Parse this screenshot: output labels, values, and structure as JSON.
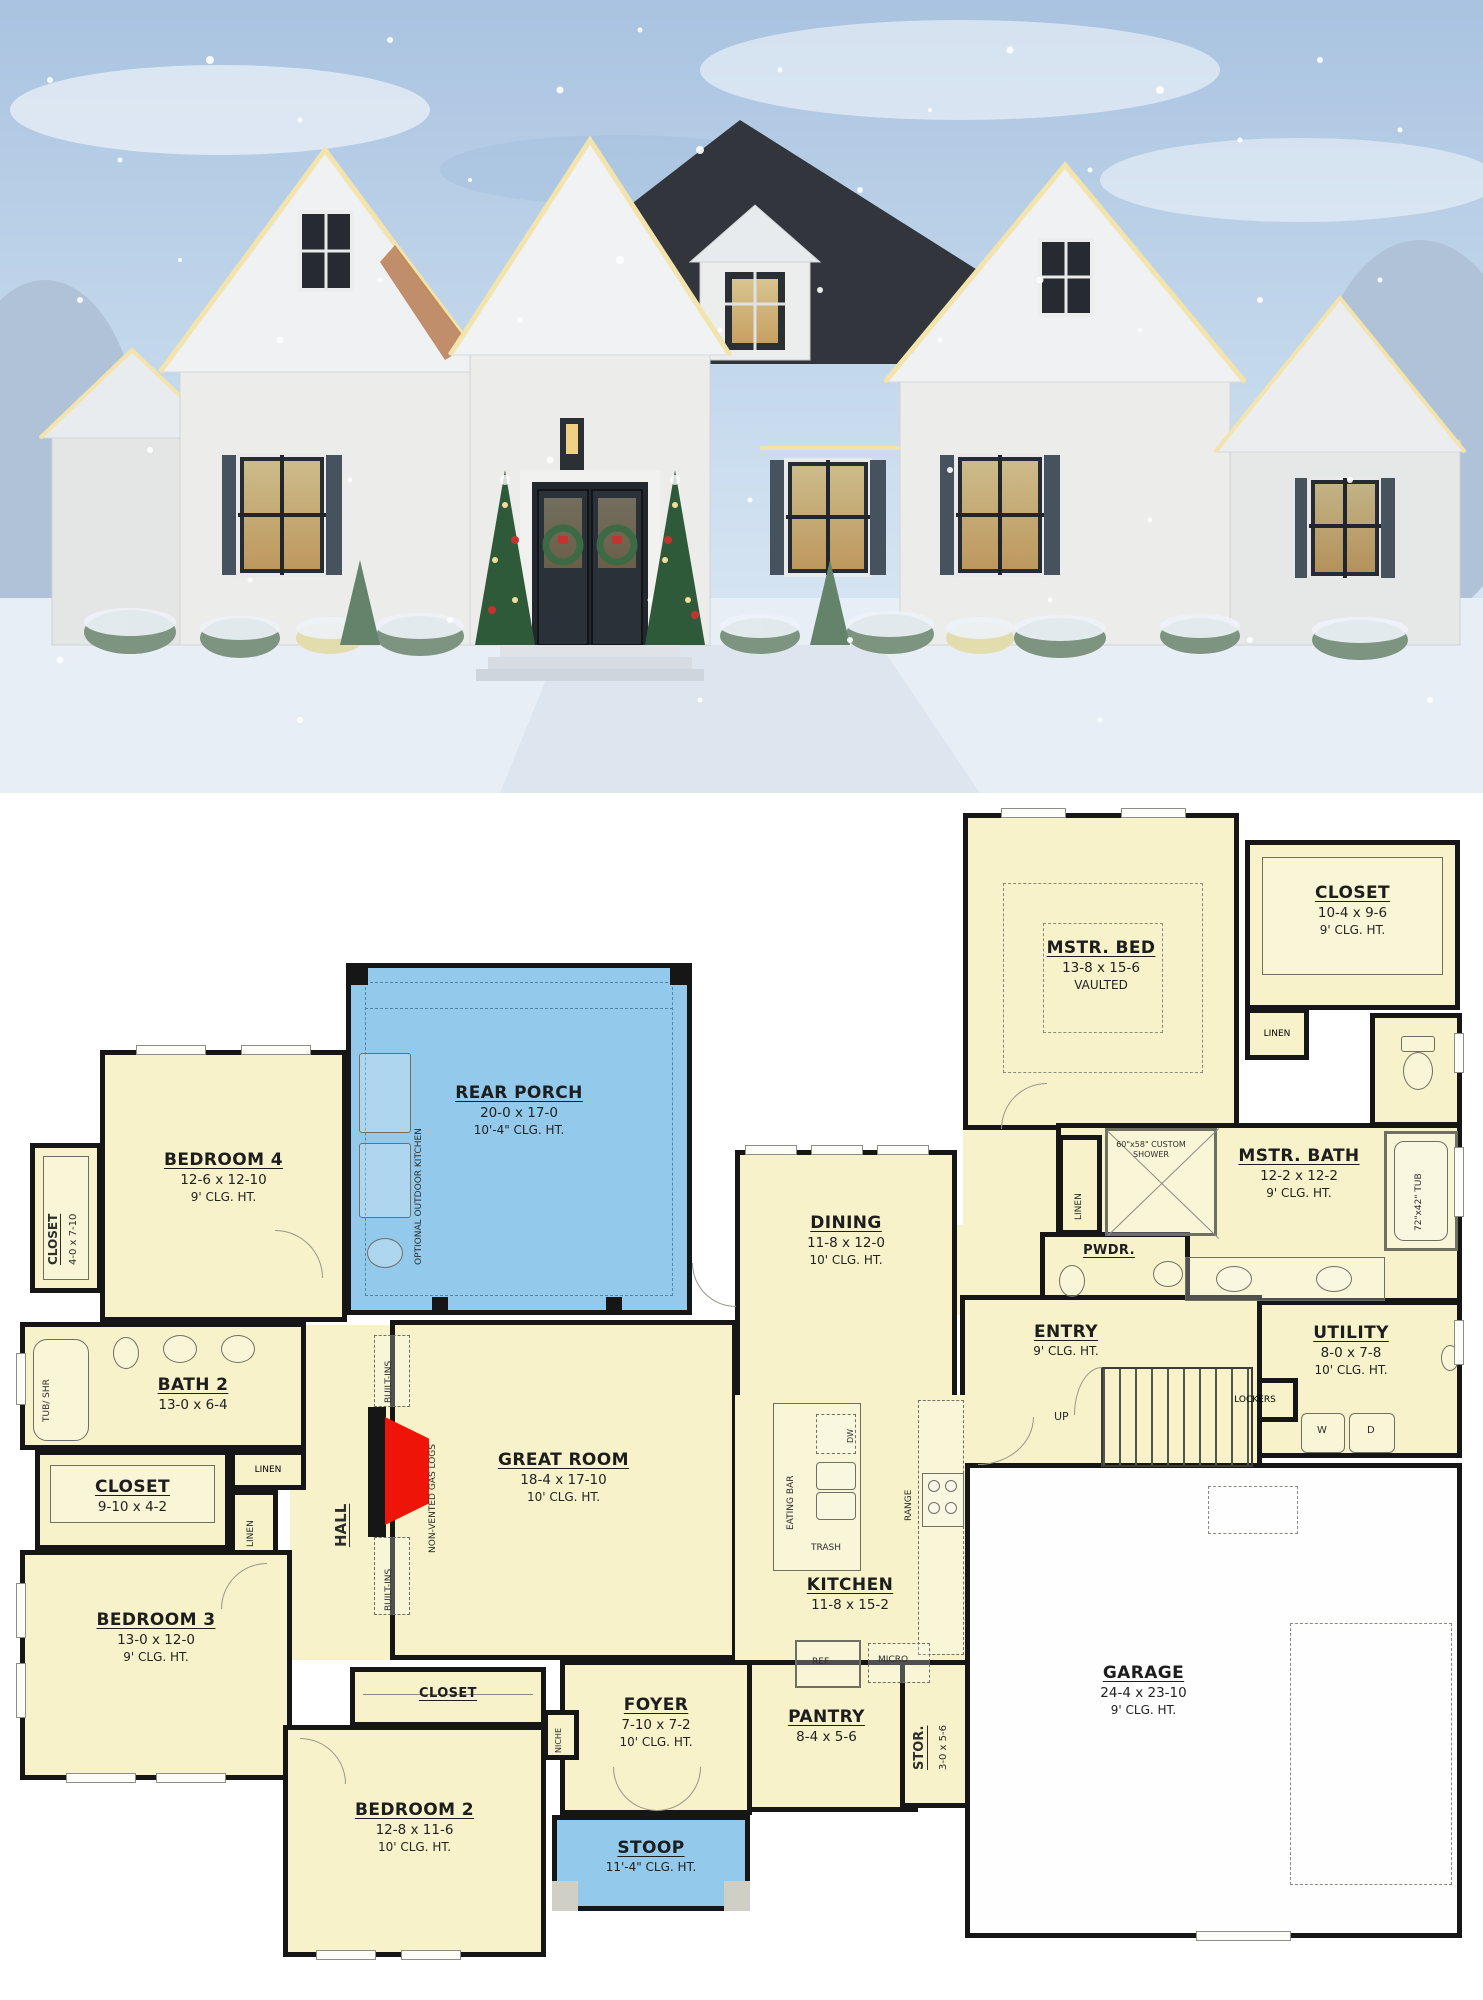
{
  "photo": {
    "scene": "white-brick house with christmas decorations in snow"
  },
  "colors": {
    "room_fill": "#f7f2ca",
    "porch_fill": "#93c9ea",
    "wall": "#161616",
    "fireplace_red": "#ee1408",
    "roof_dark": "#32363c",
    "sky_top": "#a9c3e0"
  },
  "plan": {
    "rooms": {
      "rear_porch": {
        "name": "REAR PORCH",
        "dims": "20-0 x 17-0",
        "clg": "10'-4\" CLG. HT."
      },
      "mstr_bed": {
        "name": "MSTR. BED",
        "dims": "13-8 x 15-6",
        "note": "VAULTED"
      },
      "mstr_closet": {
        "name": "CLOSET",
        "dims": "10-4 x 9-6",
        "clg": "9' CLG. HT."
      },
      "mstr_bath": {
        "name": "MSTR. BATH",
        "dims": "12-2 x 12-2",
        "clg": "9' CLG. HT."
      },
      "pwdr": {
        "name": "PWDR."
      },
      "utility": {
        "name": "UTILITY",
        "dims": "8-0 x 7-8",
        "clg": "10' CLG. HT."
      },
      "entry": {
        "name": "ENTRY",
        "clg": "9' CLG. HT."
      },
      "dining": {
        "name": "DINING",
        "dims": "11-8 x 12-0",
        "clg": "10' CLG. HT."
      },
      "great_room": {
        "name": "GREAT ROOM",
        "dims": "18-4 x 17-10",
        "clg": "10' CLG. HT."
      },
      "kitchen": {
        "name": "KITCHEN",
        "dims": "11-8 x 15-2"
      },
      "pantry": {
        "name": "PANTRY",
        "dims": "8-4 x 5-6"
      },
      "stor": {
        "name": "STOR.",
        "dims": "3-0 x 5-6"
      },
      "garage": {
        "name": "GARAGE",
        "dims": "24-4 x 23-10",
        "clg": "9' CLG. HT."
      },
      "foyer": {
        "name": "FOYER",
        "dims": "7-10 x 7-2",
        "clg": "10' CLG. HT."
      },
      "stoop": {
        "name": "STOOP",
        "clg": "11'-4\" CLG. HT."
      },
      "bedroom2": {
        "name": "BEDROOM 2",
        "dims": "12-8 x 11-6",
        "clg": "10' CLG. HT."
      },
      "bedroom2_closet": {
        "name": "CLOSET"
      },
      "bedroom3": {
        "name": "BEDROOM 3",
        "dims": "13-0 x 12-0",
        "clg": "9' CLG. HT."
      },
      "bedroom4": {
        "name": "BEDROOM 4",
        "dims": "12-6 x 12-10",
        "clg": "9' CLG. HT."
      },
      "bedroom4_closet": {
        "name": "CLOSET",
        "dims": "4-0 x 7-10"
      },
      "bath2": {
        "name": "BATH 2",
        "dims": "13-0 x 6-4"
      },
      "hall_closet": {
        "name": "CLOSET",
        "dims": "9-10 x 4-2"
      },
      "hall": {
        "name": "HALL"
      }
    },
    "annotations": {
      "optional_outdoor_kitchen": "OPTIONAL OUTDOOR KITCHEN",
      "non_vented_gas_logs": "NON-VENTED GAS LOGS",
      "built_ins": "BUILT-INS",
      "linen": "LINEN",
      "tub_shr": "TUB/ SHR",
      "custom_shower": "60\"x58\" CUSTOM SHOWER",
      "tub_72x42": "72\"x42\" TUB",
      "eating_bar": "EATING BAR",
      "trash": "TRASH",
      "range": "RANGE",
      "ref": "REF.",
      "micro": "MICRO",
      "dw": "DW",
      "up": "UP",
      "lockers": "LOCKERS",
      "niche": "NICHE",
      "washer": "W",
      "dryer": "D"
    }
  }
}
